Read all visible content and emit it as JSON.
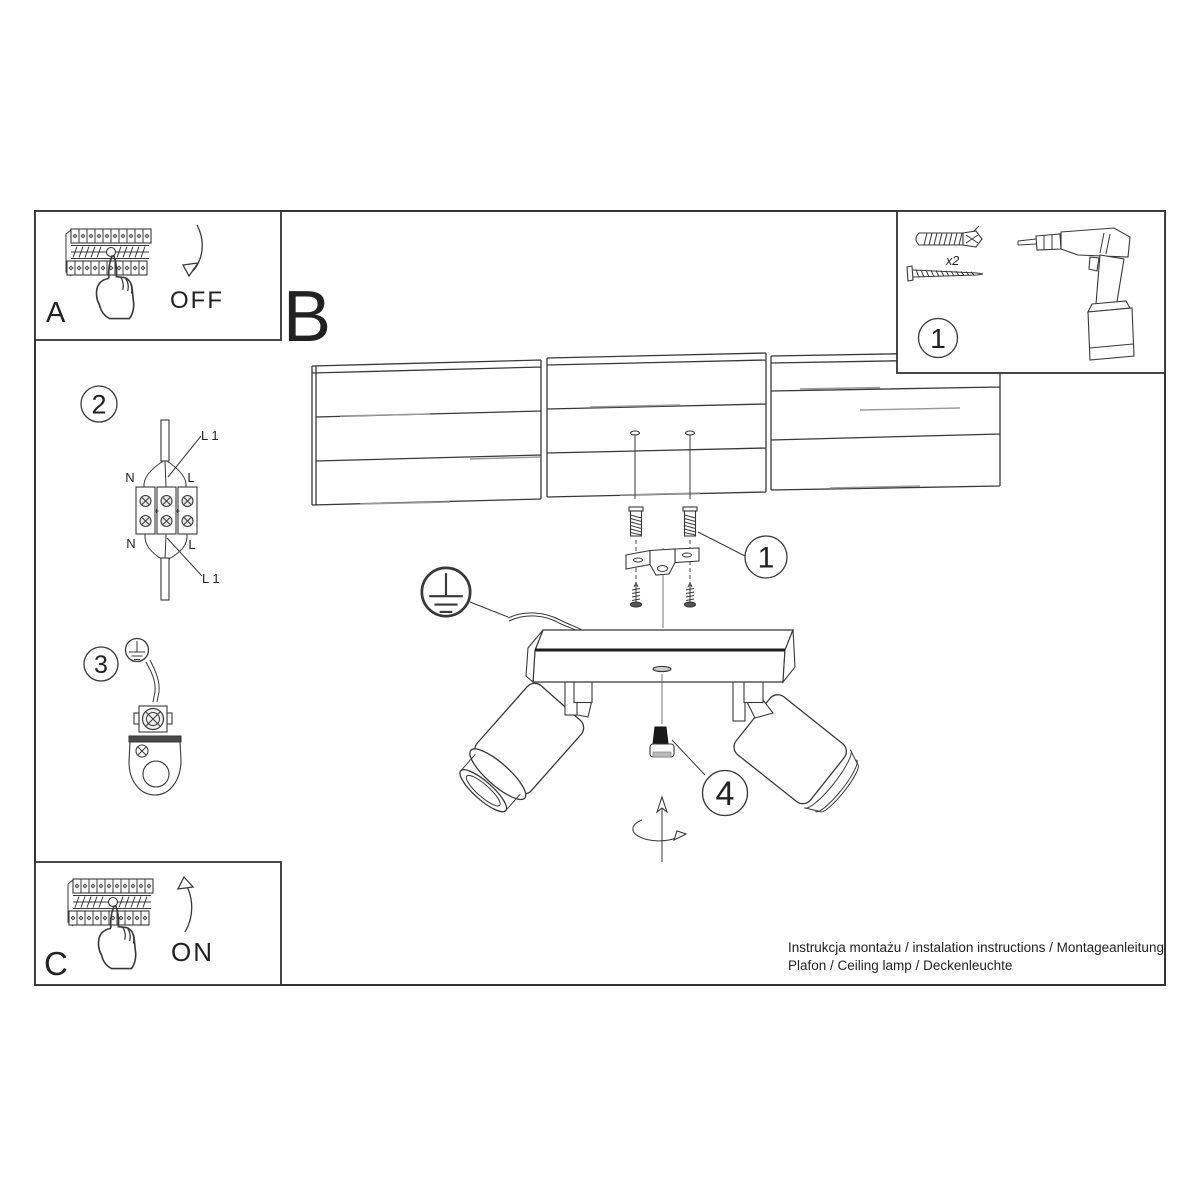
{
  "document": {
    "type": "installation-manual",
    "ink_color": "#383838",
    "paper_color": "#ffffff"
  },
  "steps": {
    "a": {
      "label": "A",
      "action": "OFF",
      "icons": [
        "breaker-panel-icon",
        "pressing-hand-icon",
        "curved-arrow-down-icon"
      ]
    },
    "b": {
      "label": "B"
    },
    "c": {
      "label": "C",
      "action": "ON",
      "icons": [
        "breaker-panel-icon",
        "pressing-hand-icon",
        "curved-arrow-up-icon"
      ]
    }
  },
  "parts_box": {
    "callout": "1",
    "quantity_label": "x2",
    "icons": [
      "wall-plug-icon",
      "mounting-screw-icon",
      "drill-icon"
    ]
  },
  "wiring_step": {
    "callout": "2",
    "labels": {
      "live_top": "L 1",
      "neutral_top": "N",
      "line_top": "L",
      "neutral_bottom": "N",
      "line_bottom": "L",
      "live_bottom": "L 1"
    },
    "icons": [
      "supply-cable-icon",
      "terminal-block-icon"
    ]
  },
  "grounding_step": {
    "callout": "3",
    "icons": [
      "earth-ground-icon",
      "ground-wire-icon",
      "ground-terminal-icon",
      "mounting-plate-icon"
    ]
  },
  "assembly": {
    "anchor_callout": "1",
    "knob_callout": "4",
    "icons": [
      "ceiling-planks-icon",
      "ceiling-screw-icon",
      "wall-plug-anchor-icon",
      "mounting-bracket-icon",
      "fixing-screw-icon",
      "earth-ground-icon",
      "supply-cable-icon",
      "lamp-base-icon",
      "lamp-holder-icon",
      "spotlight-icon",
      "adjustment-knob-icon",
      "rotation-arrow-icon"
    ]
  },
  "footer": {
    "line1": "Instrukcja montażu / instalation instructions / Montageanleitung",
    "line2": "Plafon / Ceiling lamp / Deckenleuchte"
  }
}
